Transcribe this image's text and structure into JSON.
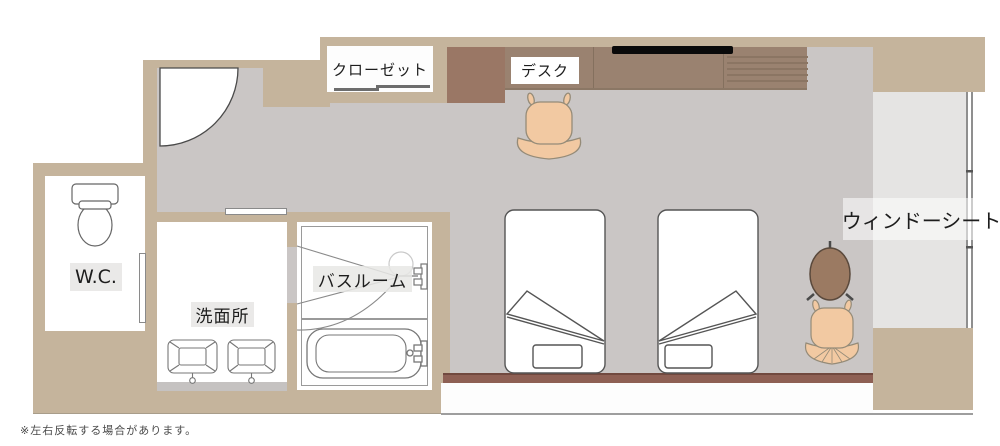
{
  "rooms": {
    "wc": "W.C.",
    "washroom": "洗面所",
    "bathroom": "バスルーム",
    "closet": "クローゼット",
    "desk": "デスク",
    "window_seat": "ウィンドーシート"
  },
  "footnote": "※左右反転する場合があります。",
  "colors": {
    "wall": "#c5b49c",
    "floor": "#cac6c5",
    "window_seat_bench": "#e5e4e3",
    "desk_counter": "#9a8270",
    "side_cabinet": "#9a7765",
    "headboard": "#8e6054",
    "chair": "#f2c9a2",
    "table": "#9b7a62",
    "tv": "#0a0a0a"
  }
}
